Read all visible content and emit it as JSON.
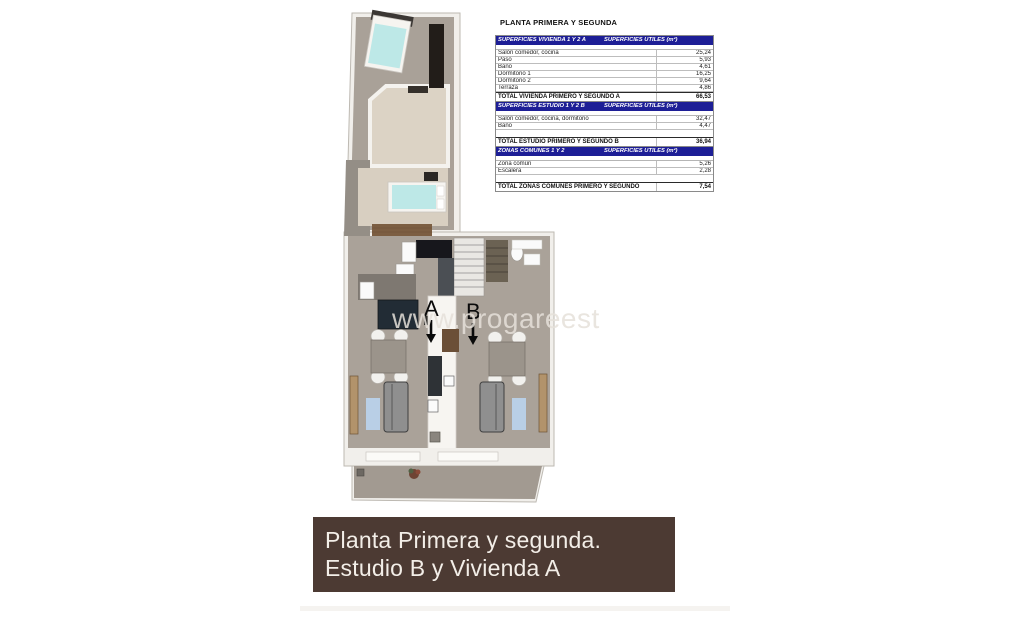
{
  "surface_tables": {
    "title": "PLANTA PRIMERA Y SEGUNDA",
    "unit_header": "SUPERFICIES UTILES  (m²)",
    "tables": [
      {
        "name": "SUPERFICIES VIVIENDA 1 Y 2 A",
        "rows": [
          {
            "label": "Salón comedor, cocina",
            "value": "25,24"
          },
          {
            "label": "Paso",
            "value": "5,93"
          },
          {
            "label": "Baño",
            "value": "4,61"
          },
          {
            "label": "Dormitorio 1",
            "value": "16,25"
          },
          {
            "label": "Dormitorio 2",
            "value": "9,64"
          },
          {
            "label": "Terraza",
            "value": "4,86"
          }
        ],
        "total": {
          "label": "TOTAL VIVIENDA PRIMERO Y SEGUNDO A",
          "value": "66,53"
        }
      },
      {
        "name": "SUPERFICIES ESTUDIO 1 Y 2 B",
        "rows": [
          {
            "label": "Salón comedor, cocina, dormitorio",
            "value": "32,47"
          },
          {
            "label": "Baño",
            "value": "4,47"
          }
        ],
        "total": {
          "label": "TOTAL ESTUDIO PRIMERO Y SEGUNDO B",
          "value": "36,94"
        }
      },
      {
        "name": "ZONAS COMUNES 1 Y 2",
        "rows": [
          {
            "label": "Zona común",
            "value": "5,26"
          },
          {
            "label": "Escalera",
            "value": "2,28"
          }
        ],
        "total": {
          "label": "TOTAL ZONAS COMUNES PRIMERO Y SEGUNDO",
          "value": "7,54"
        }
      }
    ]
  },
  "plan": {
    "unit_a": "A",
    "unit_b": "B",
    "watermark": "www.progareest"
  },
  "banner": {
    "line1": "Planta Primera y segunda.",
    "line2": "Estudio B y Vivienda A"
  },
  "colors": {
    "table_header_bg": "#1d1e96",
    "banner_bg": "#4c3a33",
    "floor_taupe": "#a9a198",
    "room_beige": "#dcd3c5",
    "bed_teal": "#bde8e7",
    "rug_blue": "#b9cfe6",
    "wood_brown": "#7c5e42"
  }
}
